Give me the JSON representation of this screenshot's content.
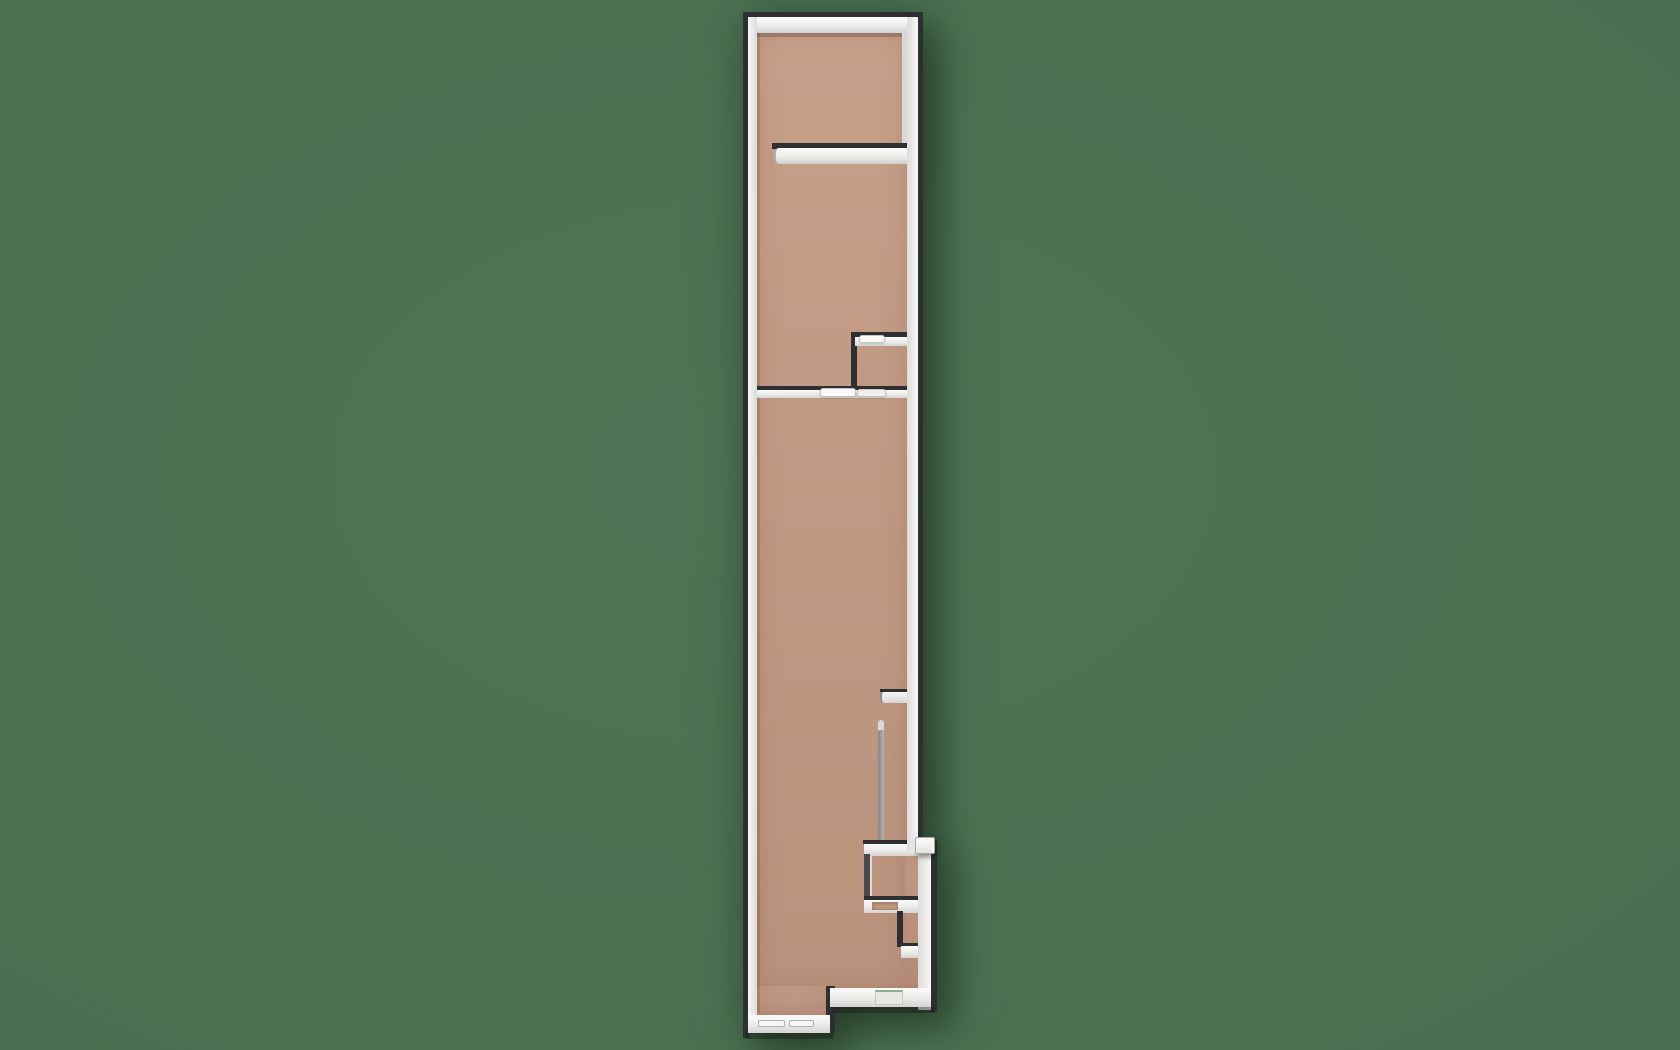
{
  "scene": {
    "type": "floorplan-3d-top-down-render",
    "canvas": {
      "width": 1680,
      "height": 1050
    },
    "palette": {
      "background": "#497150",
      "background_edge": "#41634a",
      "floor": "#c49a83",
      "wall_white": "#f1f1f0",
      "wall_bright": "#fafaf9",
      "wall_mid": "#d9d8d6",
      "wall_gray": "#9b9a98",
      "wall_dark": "#2e2f31",
      "door_dim": "#f0f0ee",
      "recess": "#e7e7e5",
      "shadow_strong": "rgba(25,30,25,0.45)",
      "shadow_soft": "rgba(70,55,45,0.25)"
    },
    "building_bounds": {
      "x": 743,
      "y": 12,
      "width": 194,
      "height": 1028
    },
    "elements": [
      {
        "name": "floor-main",
        "kind": "floor",
        "x": 757,
        "y": 30,
        "w": 150,
        "h": 958,
        "fill": "floor"
      },
      {
        "name": "floor-bottom-left",
        "kind": "floor",
        "x": 757,
        "y": 986,
        "w": 73,
        "h": 31,
        "fill": "floor"
      },
      {
        "name": "floor-right-lower",
        "kind": "floor",
        "x": 905,
        "y": 851,
        "w": 25,
        "h": 139,
        "fill": "floor"
      },
      {
        "name": "floor-contact-shadow-top",
        "kind": "shadow",
        "x": 757,
        "y": 33,
        "w": 150,
        "h": 4,
        "fill": "rgba(70,55,45,0.30)"
      },
      {
        "name": "floor-contact-shadow-left",
        "kind": "shadow",
        "x": 757,
        "y": 33,
        "w": 3,
        "h": 980,
        "fill": "rgba(70,55,45,0.18)"
      },
      {
        "name": "right-wall-inner-face",
        "kind": "plain",
        "x": 902,
        "y": 33,
        "w": 5,
        "h": 112,
        "fill": "wall_mid"
      },
      {
        "name": "upper-shelf-wall-edge",
        "kind": "dark",
        "x": 772,
        "y": 143,
        "w": 141,
        "h": 6,
        "fill": "wall_dark"
      },
      {
        "name": "upper-shelf-wall",
        "kind": "shelf1",
        "x": 774,
        "y": 148,
        "w": 133,
        "h": 16
      },
      {
        "name": "alcove-top-wall-edge",
        "kind": "dark",
        "x": 851,
        "y": 332,
        "w": 61,
        "h": 6,
        "fill": "wall_dark"
      },
      {
        "name": "alcove-left-wall-edge",
        "kind": "dark",
        "x": 851,
        "y": 332,
        "w": 6,
        "h": 61,
        "fill": "wall_dark"
      },
      {
        "name": "alcove-top-wall",
        "kind": "white-h",
        "x": 855,
        "y": 337,
        "w": 52,
        "h": 9
      },
      {
        "name": "alcove-door-leaf",
        "kind": "door",
        "x": 859,
        "y": 335,
        "w": 26,
        "h": 8,
        "fill": "wall_bright"
      },
      {
        "name": "divider-wall-edge",
        "kind": "dark",
        "x": 757,
        "y": 386,
        "w": 150,
        "h": 5,
        "fill": "wall_dark"
      },
      {
        "name": "divider-wall",
        "kind": "white-h",
        "x": 757,
        "y": 390,
        "w": 150,
        "h": 8
      },
      {
        "name": "divider-door-left-leaf",
        "kind": "door",
        "x": 820,
        "y": 388,
        "w": 36,
        "h": 9,
        "fill": "wall_bright"
      },
      {
        "name": "divider-door-right-leaf",
        "kind": "door",
        "x": 857,
        "y": 389,
        "w": 29,
        "h": 8,
        "fill": "door_dim"
      },
      {
        "name": "left-wall-door-mark",
        "kind": "plain",
        "x": 744,
        "y": 564,
        "w": 5,
        "h": 16,
        "fill": "#55565a"
      },
      {
        "name": "stub-wall-edge",
        "kind": "dark",
        "x": 880,
        "y": 689,
        "w": 30,
        "h": 3,
        "fill": "wall_dark"
      },
      {
        "name": "stub-wall",
        "kind": "stub",
        "x": 880,
        "y": 692,
        "w": 30,
        "h": 11
      },
      {
        "name": "pole-tip",
        "kind": "pole-tip",
        "x": 878,
        "y": 720,
        "w": 6,
        "h": 12,
        "fill": "wall_mid"
      },
      {
        "name": "pole",
        "kind": "pole",
        "x": 878,
        "y": 730,
        "w": 6,
        "h": 114
      },
      {
        "name": "counter-shelf-edge",
        "kind": "dark",
        "x": 863,
        "y": 840,
        "w": 55,
        "h": 4,
        "fill": "wall_dark"
      },
      {
        "name": "counter-shelf",
        "kind": "white-h",
        "x": 864,
        "y": 844,
        "w": 54,
        "h": 12
      },
      {
        "name": "counter-box-left-wall",
        "kind": "boxleft",
        "x": 864,
        "y": 854,
        "w": 8,
        "h": 46
      },
      {
        "name": "counter-box-bottom-edge",
        "kind": "dark",
        "x": 864,
        "y": 896,
        "w": 71,
        "h": 4,
        "fill": "wall_dark"
      },
      {
        "name": "counter-box-bottom",
        "kind": "white-h",
        "x": 864,
        "y": 900,
        "w": 71,
        "h": 13
      },
      {
        "name": "counter-tray",
        "kind": "tray",
        "x": 872,
        "y": 902,
        "w": 26,
        "h": 8,
        "fill": "floor"
      },
      {
        "name": "lower-box-left-edge",
        "kind": "dark",
        "x": 897,
        "y": 911,
        "w": 6,
        "h": 36,
        "fill": "wall_dark"
      },
      {
        "name": "lower-box-bottom-edge",
        "kind": "dark",
        "x": 899,
        "y": 943,
        "w": 36,
        "h": 3,
        "fill": "wall_dark"
      },
      {
        "name": "lower-box-bottom",
        "kind": "white-h",
        "x": 901,
        "y": 946,
        "w": 34,
        "h": 12
      },
      {
        "name": "top-wall-outer-edge",
        "kind": "dark",
        "x": 743,
        "y": 12,
        "w": 180,
        "h": 6,
        "fill": "wall_dark"
      },
      {
        "name": "top-wall",
        "kind": "white-h",
        "x": 748,
        "y": 17,
        "w": 172,
        "h": 16
      },
      {
        "name": "left-wall-outer-edge",
        "kind": "dark",
        "x": 743,
        "y": 12,
        "w": 6,
        "h": 1026,
        "fill": "wall_dark"
      },
      {
        "name": "left-wall",
        "kind": "white-vl",
        "x": 748,
        "y": 17,
        "w": 9,
        "h": 1016
      },
      {
        "name": "right-wall-upper-outer-edge",
        "kind": "dark",
        "x": 917,
        "y": 12,
        "w": 6,
        "h": 841,
        "fill": "wall_dark"
      },
      {
        "name": "right-wall-upper",
        "kind": "white-vr",
        "x": 907,
        "y": 17,
        "w": 11,
        "h": 836
      },
      {
        "name": "right-wall-lower-outer-edge",
        "kind": "dark",
        "x": 930,
        "y": 841,
        "w": 7,
        "h": 171,
        "fill": "wall_dark"
      },
      {
        "name": "right-wall-lower",
        "kind": "white-vr",
        "x": 918,
        "y": 838,
        "w": 13,
        "h": 172
      },
      {
        "name": "bottom-step-edge",
        "kind": "dark",
        "x": 826,
        "y": 986,
        "w": 9,
        "h": 47,
        "fill": "wall_dark"
      },
      {
        "name": "bottom-wall-right",
        "kind": "white-h",
        "x": 830,
        "y": 988,
        "w": 101,
        "h": 19
      },
      {
        "name": "bottom-wall-right-shadow",
        "kind": "shadow",
        "x": 832,
        "y": 1007,
        "w": 103,
        "h": 6,
        "fill": "rgba(25,30,25,0.45)"
      },
      {
        "name": "entry-recess",
        "kind": "recess",
        "x": 875,
        "y": 990,
        "w": 28,
        "h": 15,
        "fill": "recess"
      },
      {
        "name": "bottom-wall-left",
        "kind": "white-h",
        "x": 748,
        "y": 1015,
        "w": 82,
        "h": 18
      },
      {
        "name": "bottom-wall-left-shadow",
        "kind": "shadow",
        "x": 746,
        "y": 1033,
        "w": 88,
        "h": 6,
        "fill": "rgba(25,30,25,0.45)"
      },
      {
        "name": "bottom-window-left",
        "kind": "slit",
        "x": 758,
        "y": 1020,
        "w": 27,
        "h": 7,
        "fill": "#f6f6f4"
      },
      {
        "name": "bottom-window-right",
        "kind": "slit",
        "x": 789,
        "y": 1020,
        "w": 25,
        "h": 7,
        "fill": "#f6f6f4"
      },
      {
        "name": "wall-bump-box",
        "kind": "bump",
        "x": 915,
        "y": 837,
        "w": 20,
        "h": 17
      }
    ]
  }
}
